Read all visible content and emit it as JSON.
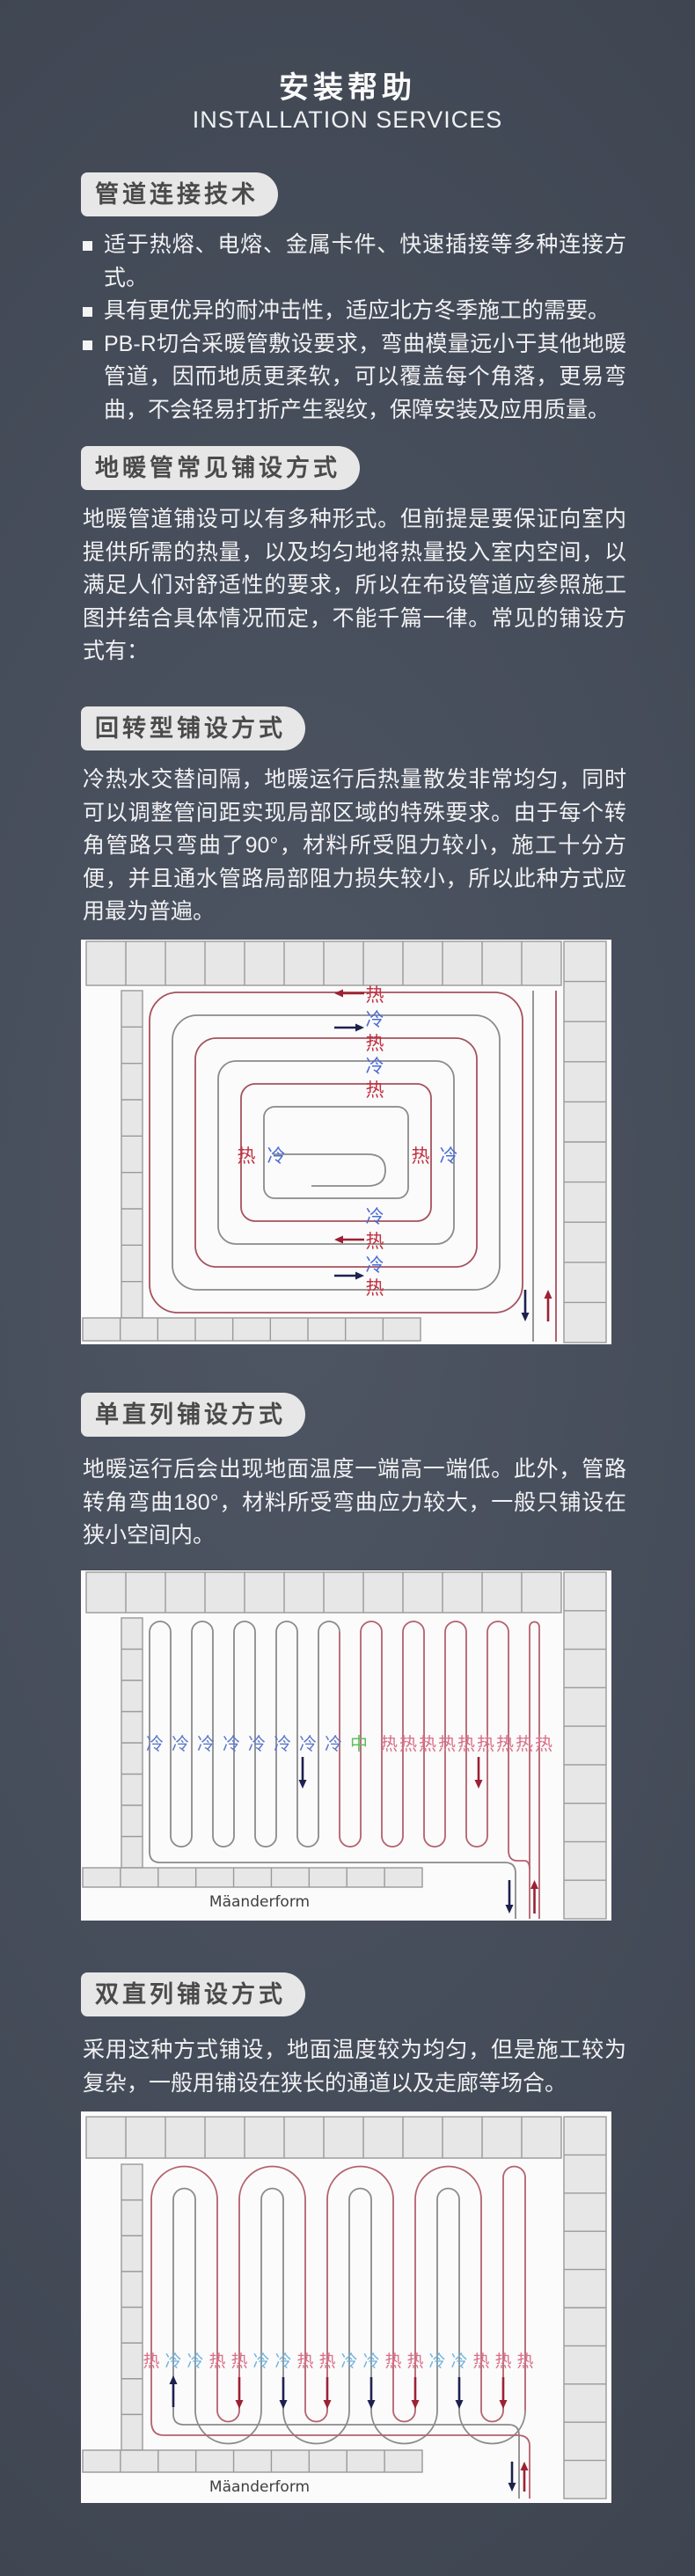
{
  "header": {
    "title": "安装帮助",
    "subtitle": "INSTALLATION SERVICES"
  },
  "sections": [
    {
      "heading": "管道连接技术",
      "bullets": [
        "适于热熔、电熔、金属卡件、快速插接等多种连接方式。",
        "具有更优异的耐冲击性，适应北方冬季施工的需要。",
        "PB-R切合采暖管敷设要求，弯曲模量远小于其他地暖管道，因而地质更柔软，可以覆盖每个角落，更易弯曲，不会轻易打折产生裂纹，保障安装及应用质量。"
      ]
    },
    {
      "heading": "地暖管常见铺设方式",
      "paragraph": "地暖管道铺设可以有多种形式。但前提是要保证向室内提供所需的热量，以及均匀地将热量投入室内空间，以满足人们对舒适性的要求，所以在布设管道应参照施工图并结合具体情况而定，不能千篇一律。常见的铺设方式有："
    },
    {
      "heading": "回转型铺设方式",
      "paragraph": "冷热水交替间隔，地暖运行后热量散发非常均匀，同时可以调整管间距实现局部区域的特殊要求。由于每个转角管路只弯曲了90°，材料所受阻力较小，施工十分方便，并且通水管路局部阻力损失较小，所以此种方式应用最为普遍。",
      "diagram": {
        "type": "spiral-layout-plan",
        "top_labels": [
          "热",
          "冷",
          "热",
          "冷",
          "热"
        ],
        "left_mid_labels": [
          "热",
          "冷"
        ],
        "right_mid_labels": [
          "热",
          "冷"
        ],
        "bottom_labels": [
          "冷",
          "热",
          "冷",
          "热"
        ]
      }
    },
    {
      "heading": "单直列铺设方式",
      "paragraph": "地暖运行后会出现地面温度一端高一端低。此外，管路转角弯曲180°，材料所受弯曲应力较大，一般只铺设在狭小空间内。",
      "diagram": {
        "type": "single-meander-plan",
        "cold_labels": [
          "冷",
          "冷",
          "冷",
          "冷",
          "冷",
          "冷",
          "冷",
          "冷"
        ],
        "center_label": "中",
        "hot_labels": [
          "热",
          "热",
          "热",
          "热",
          "热",
          "热",
          "热",
          "热",
          "热"
        ],
        "caption": "Mäanderform"
      }
    },
    {
      "heading": "双直列铺设方式",
      "paragraph": "采用这种方式铺设，地面温度较为均匀，但是施工较为复杂，一般用铺设在狭长的通道以及走廊等场合。",
      "diagram": {
        "type": "double-meander-plan",
        "label_pattern": [
          "热",
          "冷",
          "冷",
          "热",
          "热",
          "冷",
          "冷",
          "热",
          "热",
          "冷",
          "冷",
          "热",
          "热",
          "冷",
          "冷",
          "热",
          "热",
          "热"
        ],
        "caption": "Mäanderform"
      }
    }
  ],
  "colors": {
    "hot_red_d1": "#c03040",
    "cold_blue_d1": "#4a6bd6",
    "hot_pink": "#d9708a",
    "cold_blue_d2": "#5b79c9",
    "cold_lightblue_d3": "#74b4e0",
    "center_green": "#5fbe5f",
    "pipe_red": "#a5525c",
    "pipe_red_light": "#b4616e",
    "pipe_gray": "#8b8b8b",
    "arrow_navy": "#1d2150",
    "arrow_darkred": "#9c2134",
    "tile_fill": "#e7e7e7",
    "tile_stroke": "#9a9a9a",
    "diagram_bg": "#fbfbfb",
    "caption_color": "#3f3f3f"
  }
}
